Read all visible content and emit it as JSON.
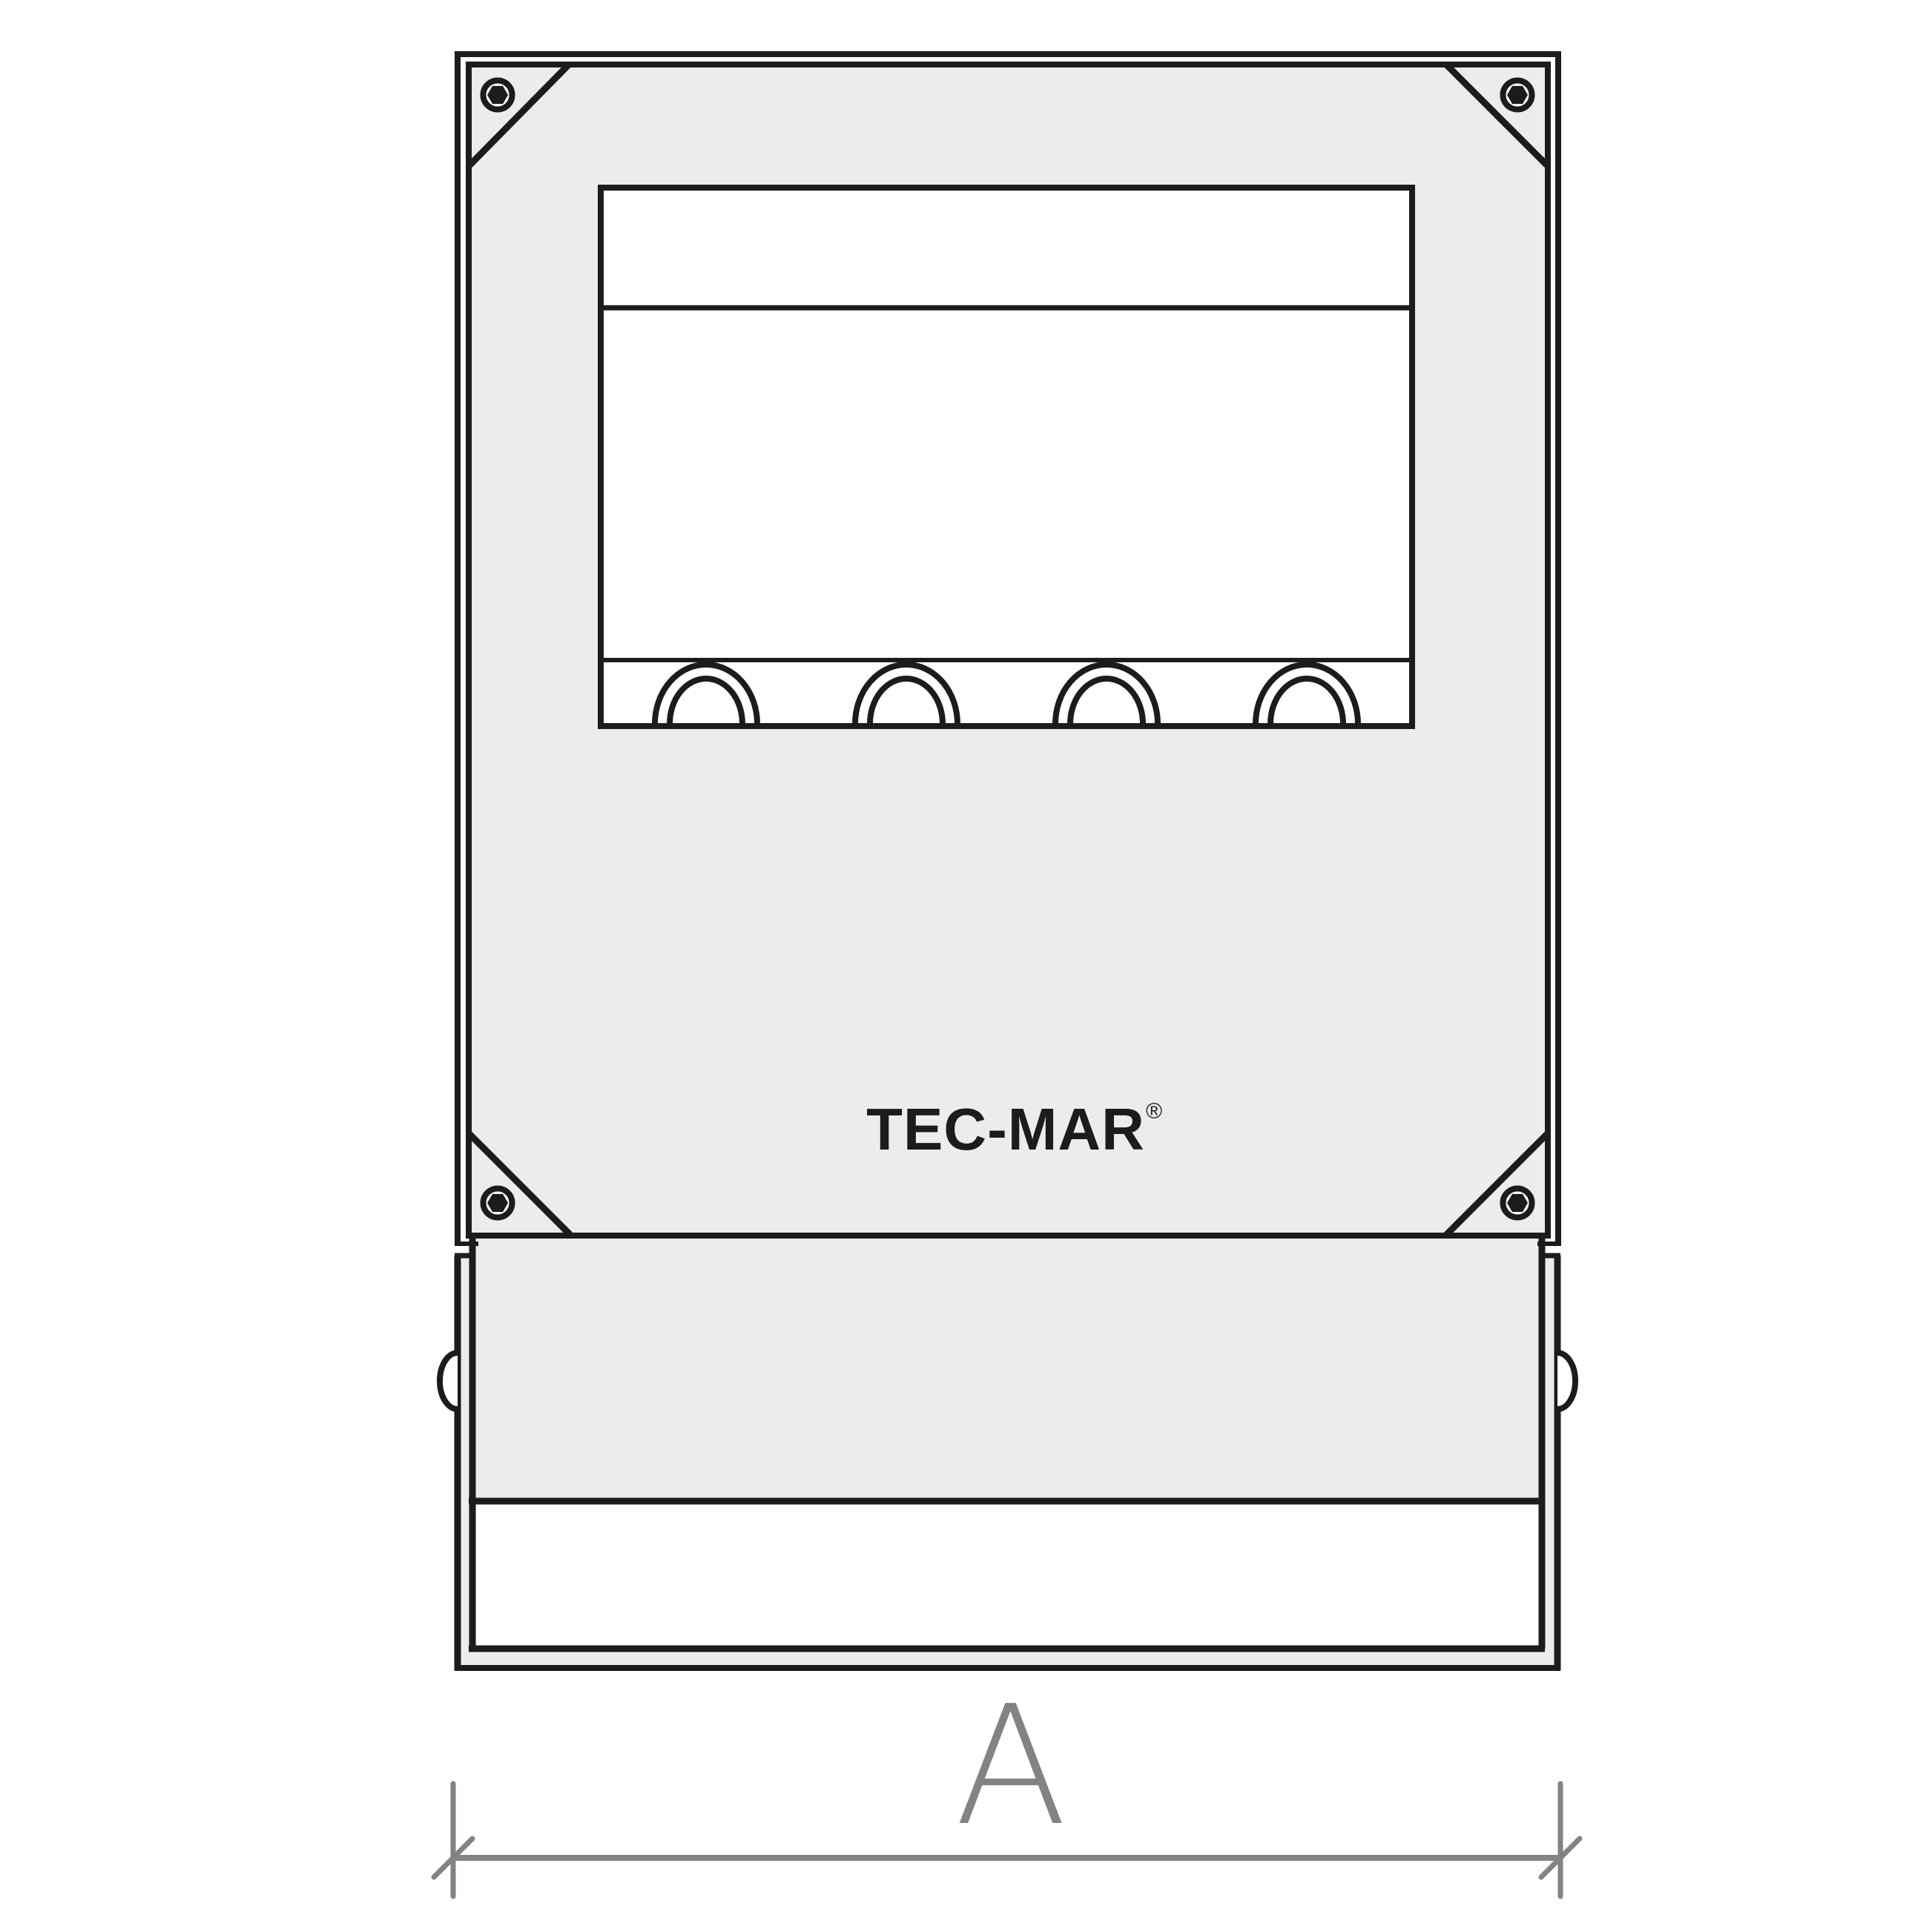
{
  "colors": {
    "line": "#1c1c1b",
    "panel": "#ececec",
    "dim": "#838383",
    "bg": "#ffffff"
  },
  "logo": {
    "text": "TEC-MAR",
    "registered": "®"
  },
  "dimension": {
    "label": "A"
  }
}
